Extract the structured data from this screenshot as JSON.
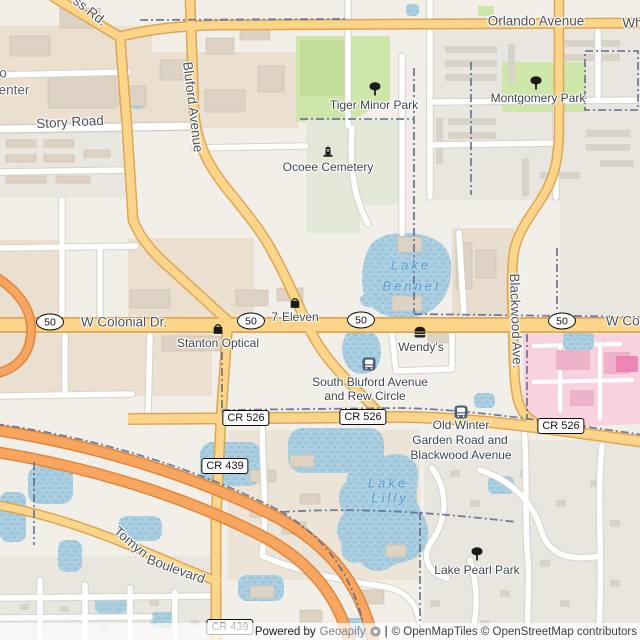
{
  "map": {
    "labels": [
      {
        "name": "road-label-ss-rd-fragment",
        "text": "ss Rd.",
        "x": 90,
        "y": 11,
        "rot": 38,
        "cls": "road"
      },
      {
        "name": "road-label-orlando-avenue",
        "text": "Orlando Avenue",
        "x": 536,
        "y": 21,
        "rot": 0,
        "cls": "road"
      },
      {
        "name": "road-label-white-road-fragment",
        "text": "Whi",
        "x": 634,
        "y": 23,
        "rot": 0,
        "cls": "road"
      },
      {
        "name": "place-label-fragment-o",
        "text": "o",
        "x": 3,
        "y": 73,
        "rot": 0,
        "cls": "place"
      },
      {
        "name": "place-label-fragment-enter",
        "text": "enter",
        "x": 14,
        "y": 90,
        "rot": 0,
        "cls": "place"
      },
      {
        "name": "road-label-story-road",
        "text": "Story Road",
        "x": 70,
        "y": 122,
        "rot": -3,
        "cls": "road"
      },
      {
        "name": "road-label-bluford-avenue",
        "text": "Bluford Avenue",
        "x": 193,
        "y": 107,
        "rot": 83,
        "cls": "road"
      },
      {
        "name": "poi-label-tiger-minor-park",
        "text": "Tiger Minor Park",
        "x": 374,
        "y": 105,
        "rot": 0,
        "cls": "poi"
      },
      {
        "name": "poi-label-montgomery-park",
        "text": "Montgomery Park",
        "x": 538,
        "y": 98,
        "rot": 0,
        "cls": "poi"
      },
      {
        "name": "poi-label-ocoee-cemetery",
        "text": "Ocoee Cemetery",
        "x": 328,
        "y": 167,
        "rot": 0,
        "cls": "poi"
      },
      {
        "name": "water-label-lake-bennet-line1",
        "text": "Lake",
        "x": 411,
        "y": 265,
        "rot": 0,
        "cls": "water"
      },
      {
        "name": "water-label-lake-bennet-line2",
        "text": "Bennet",
        "x": 412,
        "y": 286,
        "rot": 0,
        "cls": "water"
      },
      {
        "name": "road-label-w-colonial-dr",
        "text": "W Colonial Dr.",
        "x": 124,
        "y": 322,
        "rot": 0,
        "cls": "road"
      },
      {
        "name": "road-label-w-colonial-fragment",
        "text": "W Colo",
        "x": 628,
        "y": 321,
        "rot": 0,
        "cls": "road"
      },
      {
        "name": "poi-label-7-eleven",
        "text": "7-Eleven",
        "x": 295,
        "y": 317,
        "rot": 0,
        "cls": "poi"
      },
      {
        "name": "poi-label-stanton-optical",
        "text": "Stanton Optical",
        "x": 218,
        "y": 343,
        "rot": 0,
        "cls": "poi"
      },
      {
        "name": "poi-label-wendys",
        "text": "Wendy's",
        "x": 421,
        "y": 347,
        "rot": 0,
        "cls": "poi"
      },
      {
        "name": "road-label-blackwood-ave",
        "text": "Blackwood Ave.",
        "x": 516,
        "y": 321,
        "rot": 88,
        "cls": "road"
      },
      {
        "name": "poi-label-bus-stop-south-bluford-line1",
        "text": "South Bluford Avenue",
        "x": 370,
        "y": 382,
        "rot": 0,
        "cls": "poi"
      },
      {
        "name": "poi-label-bus-stop-south-bluford-line2",
        "text": "and Rew Circle",
        "x": 365,
        "y": 396,
        "rot": 0,
        "cls": "poi"
      },
      {
        "name": "poi-label-bus-stop-old-winter-line1",
        "text": "Old Winter",
        "x": 461,
        "y": 425,
        "rot": 0,
        "cls": "poi"
      },
      {
        "name": "poi-label-bus-stop-old-winter-line2",
        "text": "Garden Road and",
        "x": 460,
        "y": 440,
        "rot": 0,
        "cls": "poi"
      },
      {
        "name": "poi-label-bus-stop-old-winter-line3",
        "text": "Blackwood Avenue",
        "x": 461,
        "y": 455,
        "rot": 0,
        "cls": "poi"
      },
      {
        "name": "water-label-lake-lilly-line1",
        "text": "Lake",
        "x": 388,
        "y": 483,
        "rot": 0,
        "cls": "water"
      },
      {
        "name": "water-label-lake-lilly-line2",
        "text": "Lilly",
        "x": 390,
        "y": 498,
        "rot": 0,
        "cls": "water"
      },
      {
        "name": "road-label-tomyn-boulevard-word1",
        "text": "Tomyn",
        "x": 131,
        "y": 542,
        "rot": 40,
        "cls": "road"
      },
      {
        "name": "road-label-tomyn-boulevard-word2",
        "text": "Boulevard",
        "x": 176,
        "y": 569,
        "rot": 20,
        "cls": "road"
      },
      {
        "name": "poi-label-lake-pearl-park",
        "text": "Lake Pearl Park",
        "x": 477,
        "y": 570,
        "rot": 0,
        "cls": "poi"
      }
    ],
    "icons": [
      {
        "glyph": "tree",
        "x": 375,
        "y": 89
      },
      {
        "glyph": "tree",
        "x": 536,
        "y": 83
      },
      {
        "glyph": "grave",
        "x": 328,
        "y": 151
      },
      {
        "glyph": "bag",
        "x": 295,
        "y": 303
      },
      {
        "glyph": "bag",
        "x": 218,
        "y": 329
      },
      {
        "glyph": "burger",
        "x": 420,
        "y": 332
      },
      {
        "glyph": "bus",
        "x": 369,
        "y": 364
      },
      {
        "glyph": "bus",
        "x": 461,
        "y": 412
      },
      {
        "glyph": "tree",
        "x": 477,
        "y": 554
      }
    ],
    "shields": [
      {
        "style": "ellipse",
        "text": "50",
        "x": 50,
        "y": 322
      },
      {
        "style": "ellipse",
        "text": "50",
        "x": 251,
        "y": 321
      },
      {
        "style": "ellipse",
        "text": "50",
        "x": 361,
        "y": 320
      },
      {
        "style": "ellipse",
        "text": "50",
        "x": 562,
        "y": 321
      },
      {
        "style": "rect",
        "text": "CR 526",
        "x": 246,
        "y": 418
      },
      {
        "style": "rect",
        "text": "CR 526",
        "x": 363,
        "y": 417
      },
      {
        "style": "rect",
        "text": "CR 526",
        "x": 561,
        "y": 426
      },
      {
        "style": "rect",
        "text": "CR 439",
        "x": 225,
        "y": 466
      },
      {
        "style": "rect",
        "text": "CR 439",
        "x": 230,
        "y": 627
      }
    ],
    "attribution": {
      "powered_by": "Powered by",
      "brand": "Geoapify",
      "separator": "|",
      "credits": "© OpenMapTiles © OpenStreetMap contributors"
    },
    "colors": {
      "base": "#f2efe9",
      "water": "#a9cfe1",
      "water_label": "#579ac9",
      "road_secondary": "#fcd58a",
      "road_casing": "#dda655",
      "motorway": "#f8a55f",
      "park": "#cfe6ab",
      "cemetery": "#e4e8d8",
      "hospital": "#f9d2e0",
      "boundary": "#5e6a8e"
    }
  }
}
